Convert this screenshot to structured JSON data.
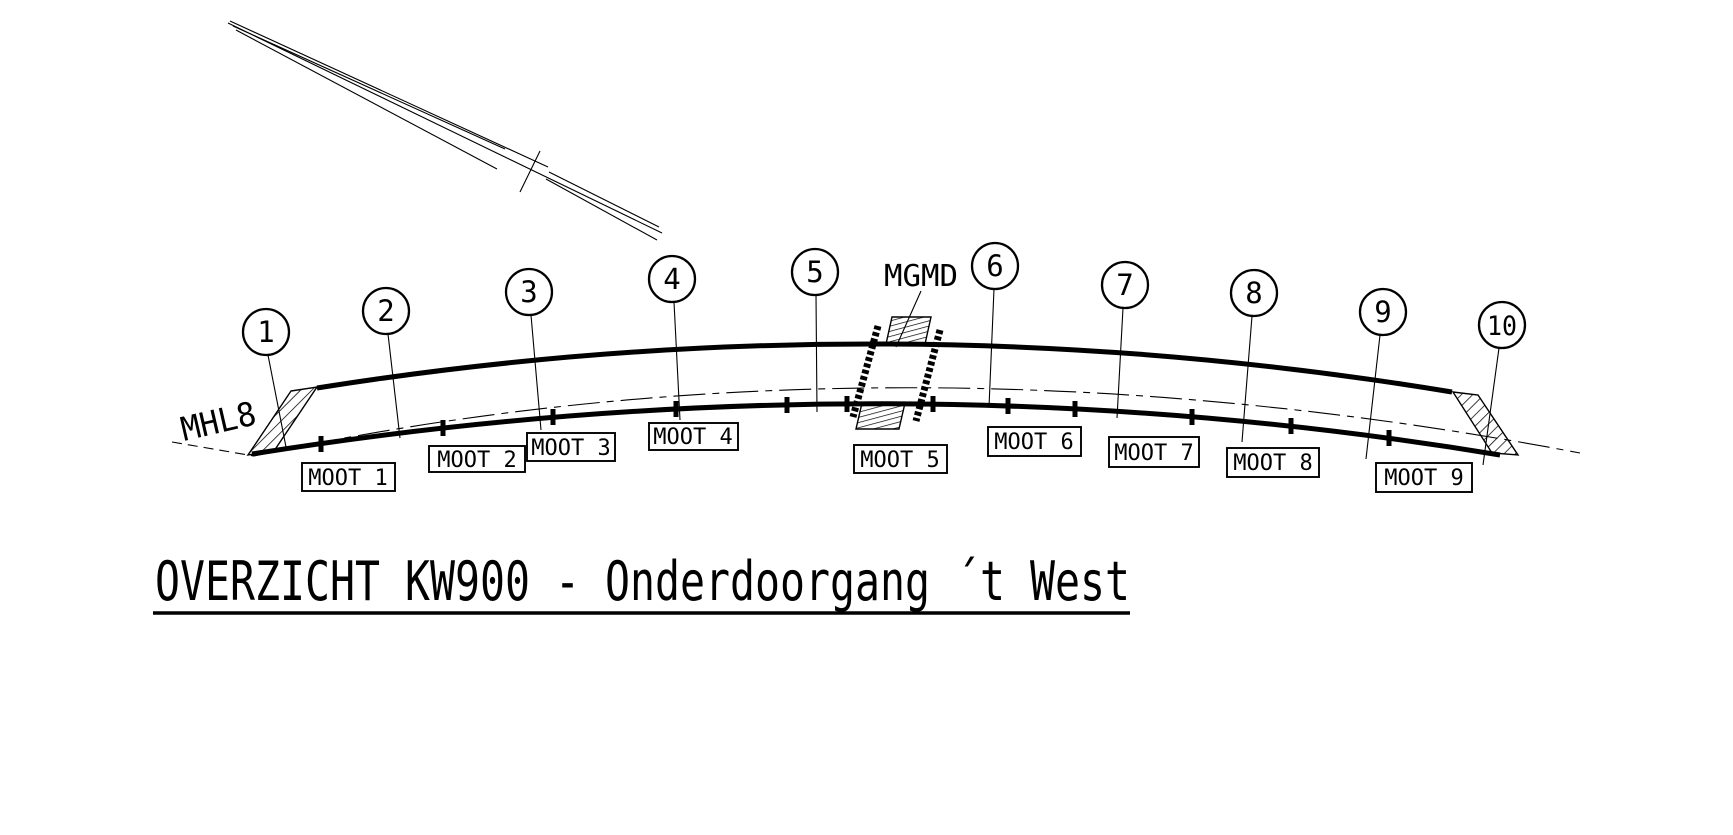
{
  "drawing": {
    "title": "OVERZICHT KW900 - Onderdoorgang ´t West",
    "alignment_label": "MHL8",
    "joint_label": "MGMD",
    "axis_markers": [
      "1",
      "2",
      "3",
      "4",
      "5",
      "6",
      "7",
      "8",
      "9",
      "10"
    ],
    "segment_labels": [
      "MOOT 1",
      "MOOT 2",
      "MOOT 3",
      "MOOT 4",
      "MOOT 5",
      "MOOT 6",
      "MOOT 7",
      "MOOT 8",
      "MOOT 9"
    ],
    "colors": {
      "line": "#000000",
      "background": "#ffffff"
    }
  }
}
